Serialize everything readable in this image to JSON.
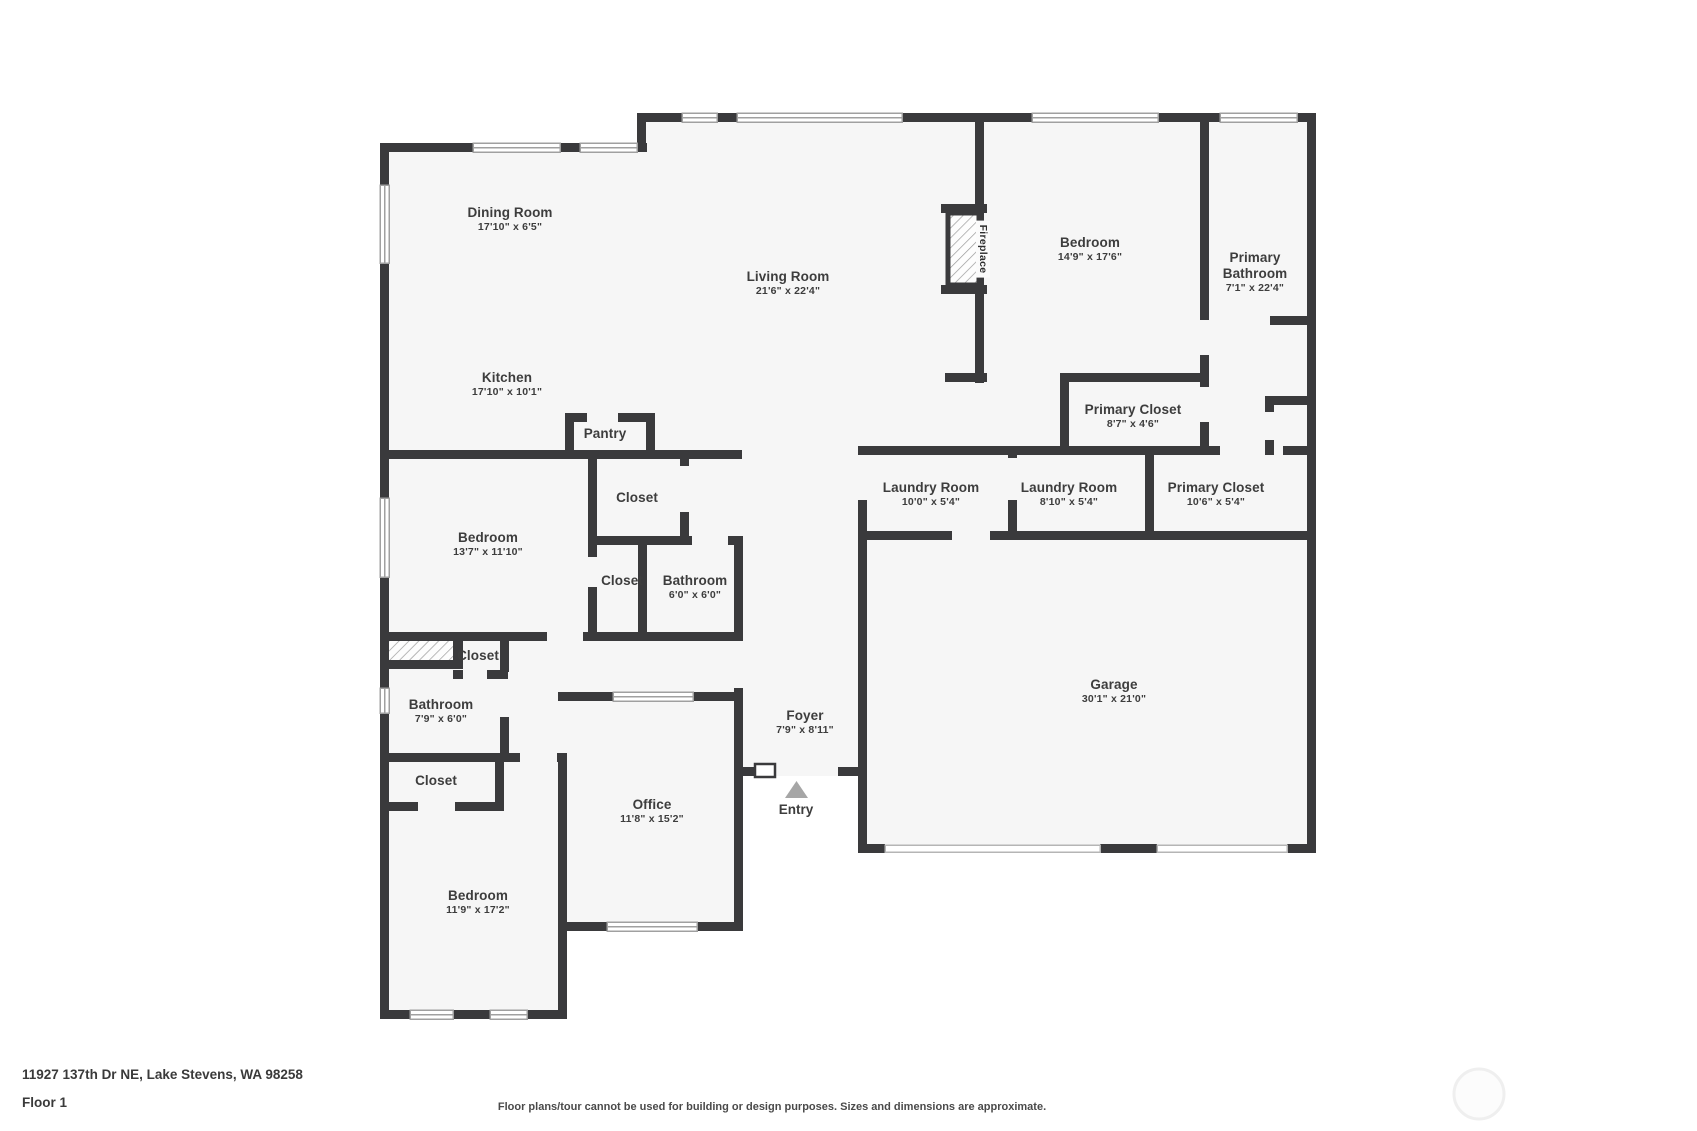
{
  "title": "Floor plan",
  "rooms": [
    {
      "name": "Dining Room",
      "dims": "17'10\" x 6'5\""
    },
    {
      "name": "Kitchen",
      "dims": "17'10\" x 10'1\""
    },
    {
      "name": "Living Room",
      "dims": "21'6\" x 22'4\""
    },
    {
      "name": "Pantry"
    },
    {
      "name": "Bedroom",
      "dims": "14'9\" x 17'6\""
    },
    {
      "name": "Primary Bathroom",
      "dims": "7'1\" x 22'4\""
    },
    {
      "name": "Primary Closet",
      "dims": "8'7\" x 4'6\""
    },
    {
      "name": "Laundry Room",
      "dims": "10'0\" x 5'4\""
    },
    {
      "name": "Laundry Room",
      "dims": "8'10\" x 5'4\""
    },
    {
      "name": "Primary Closet",
      "dims": "10'6\" x 5'4\""
    },
    {
      "name": "Closet"
    },
    {
      "name": "Bedroom",
      "dims": "13'7\" x 11'10\""
    },
    {
      "name": "Closet"
    },
    {
      "name": "Bathroom",
      "dims": "6'0\" x 6'0\""
    },
    {
      "name": "Closet"
    },
    {
      "name": "Bathroom",
      "dims": "7'9\" x 6'0\""
    },
    {
      "name": "Closet"
    },
    {
      "name": "Foyer",
      "dims": "7'9\" x 8'11\""
    },
    {
      "name": "Office",
      "dims": "11'8\" x 15'2\""
    },
    {
      "name": "Bedroom",
      "dims": "11'9\" x 17'2\""
    },
    {
      "name": "Garage",
      "dims": "30'1\" x 21'0\""
    }
  ],
  "annotations": {
    "entry": "Entry",
    "fireplace": "Fireplace"
  },
  "footer": {
    "address": "11927 137th Dr NE, Lake Stevens, WA 98258",
    "floor_label": "Floor 1",
    "disclaimer": "Floor plans/tour cannot be used for building or design purposes. Sizes and dimensions are approximate."
  },
  "colors": {
    "wall": "#3a3a3c",
    "floor": "#f6f6f6",
    "window_line": "#a0a0a0",
    "text": "#3d3d3d",
    "entry_arrow": "#a6a6a6"
  }
}
